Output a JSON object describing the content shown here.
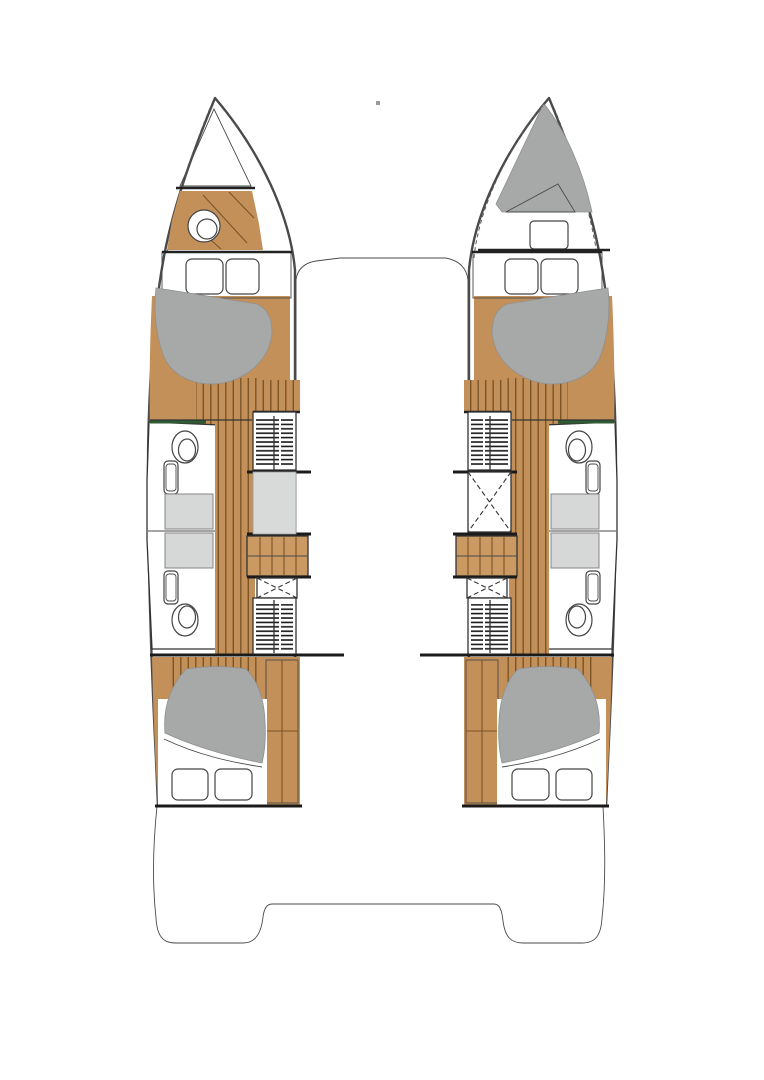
{
  "meta": {
    "description": "Top-view interior floor plan of a 4-cabin sailing catamaran; drawing only, no visible text labels",
    "visible_text": []
  },
  "legend": {
    "hulls": 2,
    "double_beds": 4,
    "bow_crew_berth": 1,
    "bow_head_with_toilet": 1,
    "mid_hull_bathrooms": 4,
    "toilets_total": 5,
    "companionway_staircases": 2,
    "stern_swim_platforms": 2
  },
  "colors": {
    "background": "#ffffff",
    "white": "#ffffff",
    "deck": "#d8d9d9",
    "hull_fill": "#ffffff",
    "hull_outline": "#4a4a4a",
    "wood": "#c3905a",
    "wood_dark_line": "#7c5527",
    "wood_furniture": "#cb9a62",
    "mattress": "#a7a8a8",
    "shower_tray": "#d6d7d7",
    "glass_green": "#2e5b33",
    "hatch_line": "#161616",
    "dot": "#999999"
  }
}
